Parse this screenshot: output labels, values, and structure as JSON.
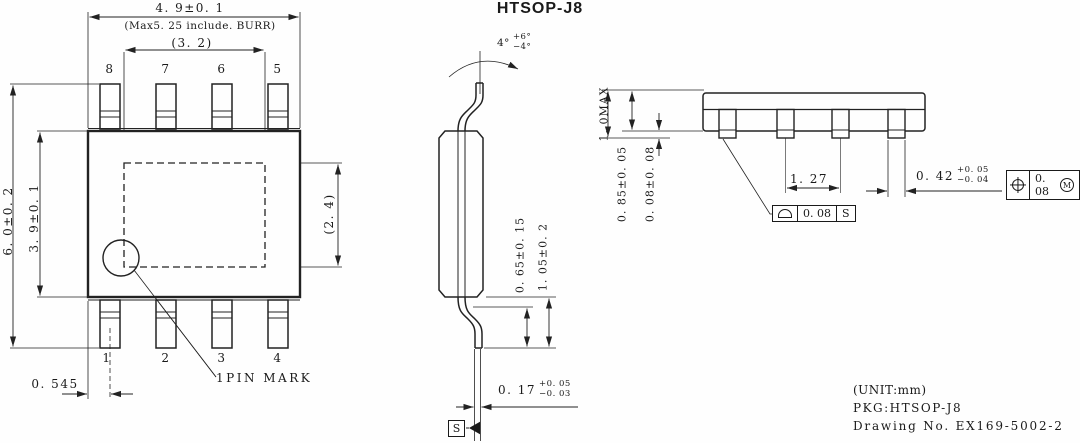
{
  "title": "HTSOP-J8",
  "top_view": {
    "pins_top": [
      "8",
      "7",
      "6",
      "5"
    ],
    "pins_bottom": [
      "1",
      "2",
      "3",
      "4"
    ],
    "dims": {
      "body_width": "4. 9±0. 1",
      "max_burr": "(Max5. 25 include. BURR)",
      "pad_width": "(3. 2)",
      "overall_height": "6. 0±0. 2",
      "body_height": "3. 9±0. 1",
      "pad_height": "(2. 4)",
      "pin1_offset": "0. 545"
    },
    "pin1_mark_label": "1PIN MARK"
  },
  "side_view": {
    "lead_angle": {
      "base": "4°",
      "plus": "+6°",
      "minus": "−4°"
    },
    "standoff": "0. 65±0. 15",
    "lead_height": "1. 05±0. 2",
    "lead_thickness": {
      "base": "0. 17",
      "plus": "+0. 05",
      "minus": "−0. 03"
    },
    "datum_label": "S"
  },
  "end_view": {
    "overall_height": "1. 0MAX",
    "body_thickness": "0. 85±0. 05",
    "standoff": "0. 08±0. 08",
    "lead_pitch": "1. 27",
    "lead_width": {
      "base": "0. 42",
      "plus": "+0. 05",
      "minus": "−0. 04"
    },
    "fcf_profile": {
      "value": "0. 08",
      "datum": "S"
    },
    "fcf_position": {
      "value": "0. 08",
      "modifier": "M"
    }
  },
  "footer": {
    "unit": "(UNIT:mm)",
    "pkg": "PKG:HTSOP-J8",
    "drawing_no": "Drawing No. EX169-5002-2"
  },
  "colors": {
    "line": "#222222",
    "text": "#1a1a1a",
    "background": "#fefefe"
  }
}
